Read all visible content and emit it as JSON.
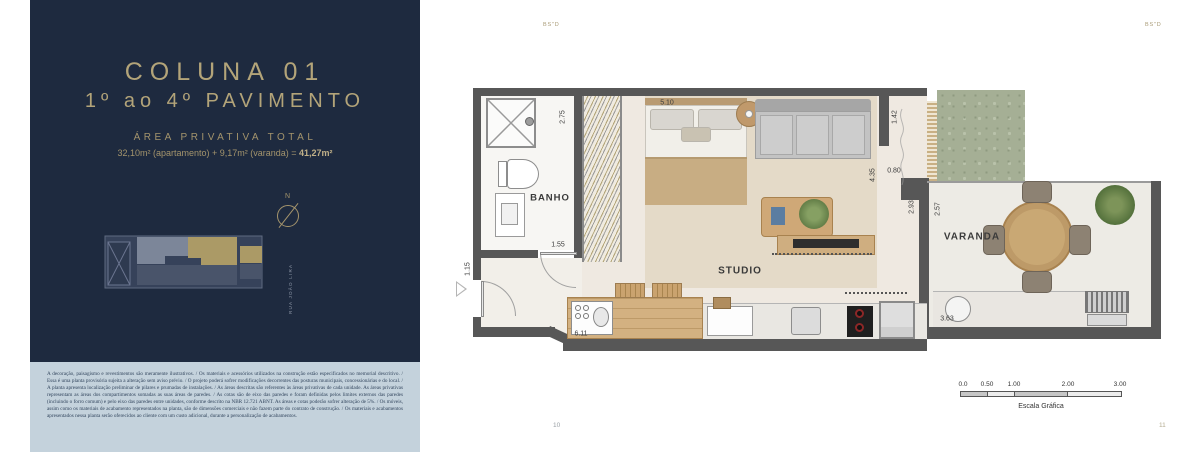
{
  "header": {
    "bsd_left": "BS\"D",
    "bsd_right": "BS\"D"
  },
  "footer": {
    "page_left": "10",
    "page_right": "11"
  },
  "panel": {
    "title_line1": "COLUNA 01",
    "title_line2": "1º ao 4º PAVIMENTO",
    "area_heading": "ÁREA PRIVATIVA TOTAL",
    "area_text": "32,10m² (apartamento) + 9,17m² (varanda) = ",
    "area_total": "41,27m²",
    "compass_n": "N",
    "street": "RUA JOÃO LIRA",
    "disclaimer": "A decoração, paisagismo e revestimentos são meramente ilustrativos. / Os materiais e acessórios utilizados na construção estão especificados no memorial descritivo. / Essa é uma planta provisória sujeita a alteração sem aviso prévio. / O projeto poderá sofrer modificações decorrentes das posturas municipais, concessionárias e do local. / A planta apresenta localização preliminar de pilares e prumadas de instalações. / As áreas descritas são referentes às áreas privativas de cada unidade. As áreas privativas representam as áreas dos compartimentos somadas as suas áreas de paredes. / As cotas são de eixo das paredes e foram definidas pelos limites externos das paredes (incluindo o forro comum) e pelo eixo das paredes entre unidades, conforme descrito na NBR 12.721 ABNT. As áreas e cotas poderão sofrer alteração de 5%. / Os móveis, assim como os materiais de acabamento representados na planta, são de dimensões comerciais e não fazem parte do contrato de construção. / Os materiais e acabamentos apresentados nessa planta serão oferecidos ao cliente com um custo adicional, durante a personalização de acabamentos."
  },
  "plan": {
    "rooms": {
      "banho": "BANHO",
      "studio": "STUDIO",
      "varanda": "VARANDA"
    },
    "dims": {
      "d275": "2.75",
      "d155": "1.55",
      "d510": "5.10",
      "d142": "1.42",
      "d080": "0.80",
      "d435": "4.35",
      "d293": "2.93",
      "d257": "2.57",
      "d115": "1.15",
      "d611": "6.11",
      "d363": "3.63"
    }
  },
  "scalebar": {
    "ticks": [
      "0.0",
      "0.50",
      "1.00",
      "2.00",
      "3.00"
    ],
    "label": "Escala Gráfica"
  },
  "colors": {
    "navy": "#1e2a3f",
    "gold": "#ab9b71",
    "unit_highlight": "#ab9a66",
    "wall": "#575757",
    "grass": "#a5af95",
    "wood": "#cfa877",
    "disclaimer_bg": "#c4d2dc"
  }
}
